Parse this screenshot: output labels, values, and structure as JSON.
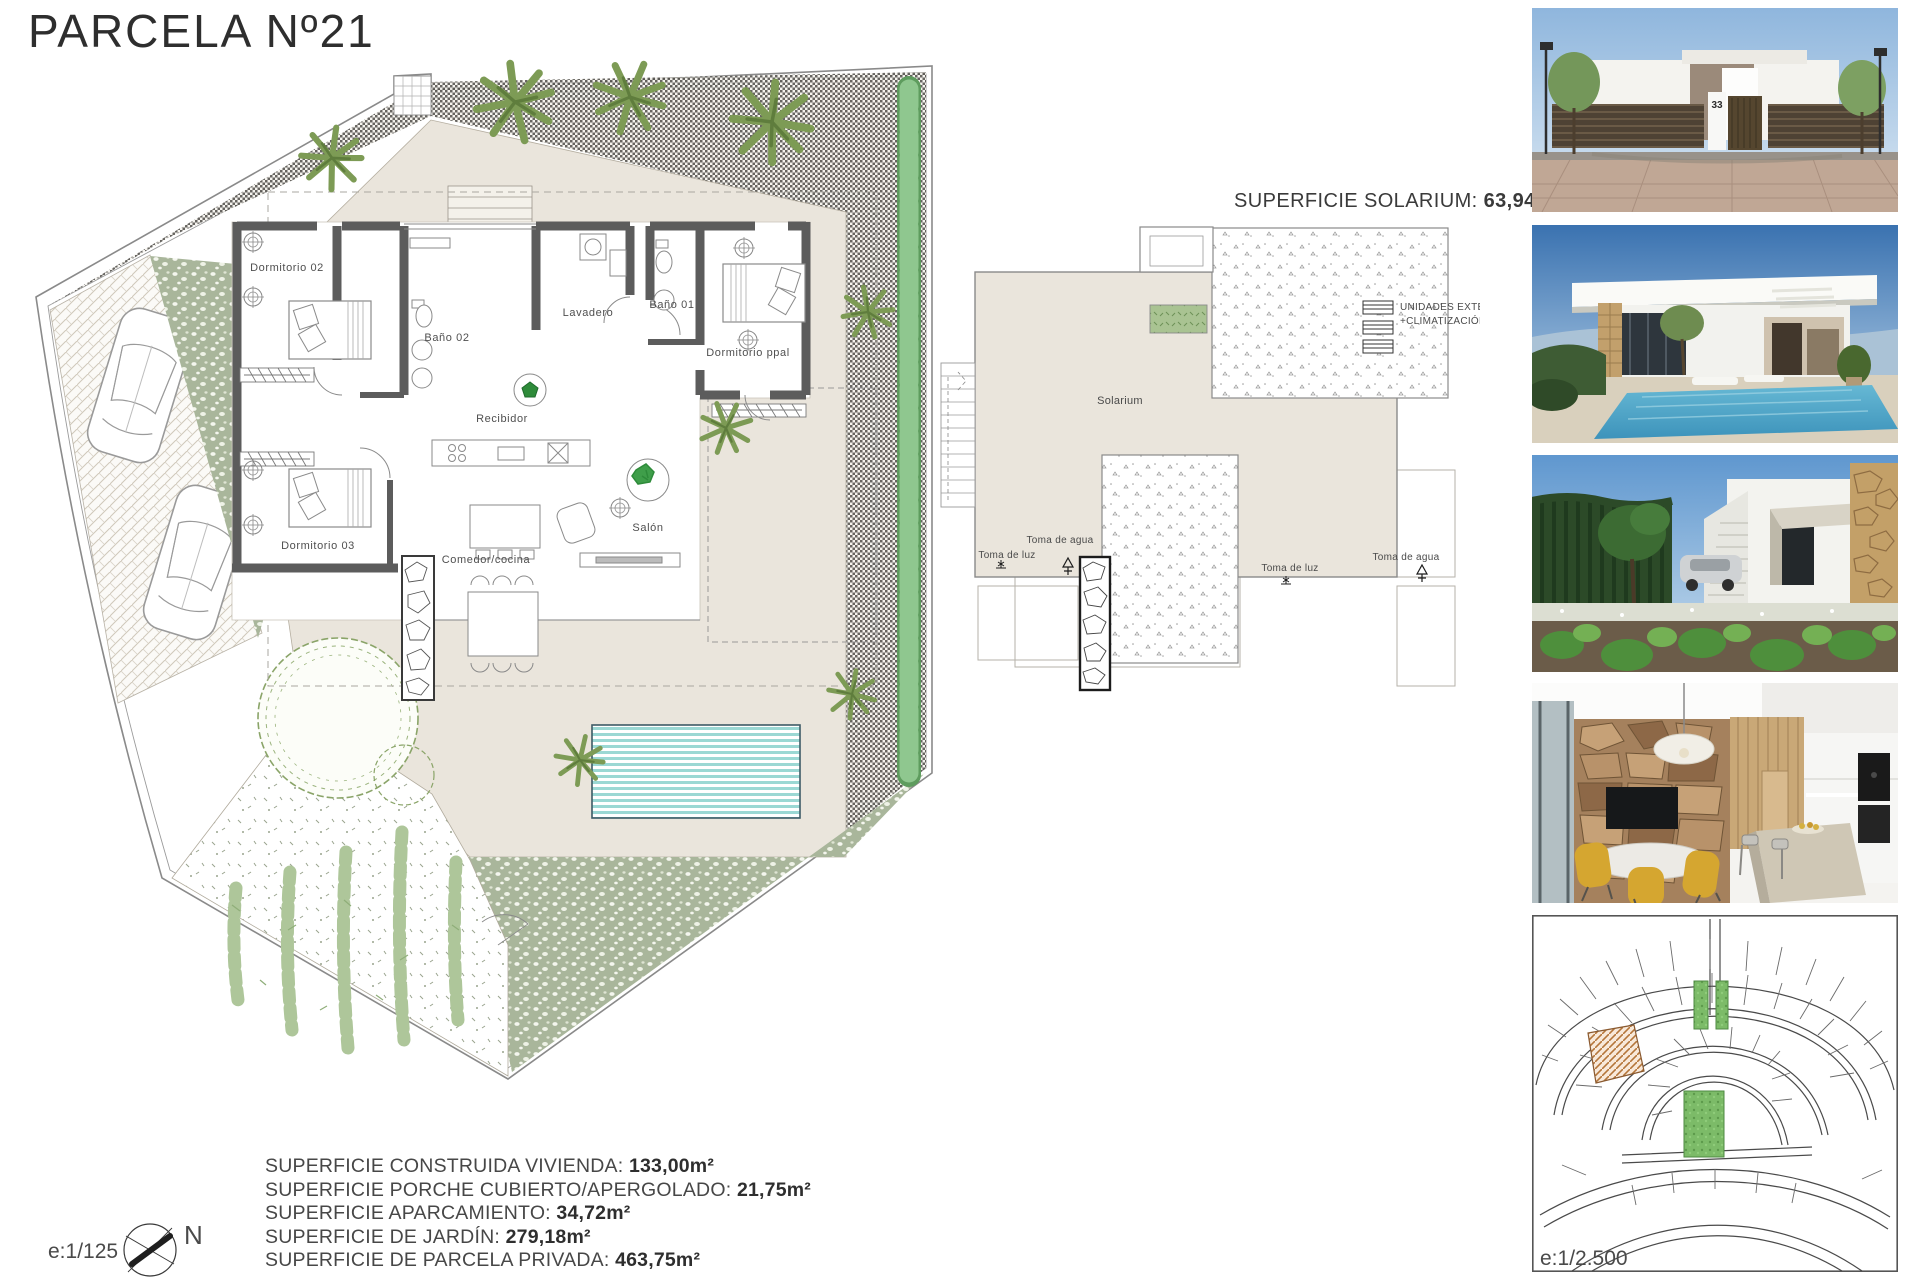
{
  "title": "PARCELA Nº21",
  "plan": {
    "rooms": [
      "Dormitorio 02",
      "Baño 02",
      "Lavadero",
      "Baño 01",
      "Dormitorio ppal",
      "Recibidor",
      "Dormitorio 03",
      "Comedor/cocina",
      "Salón"
    ],
    "scale": "e:1/125",
    "north": "N"
  },
  "solarium": {
    "title_label": "SUPERFICIE SOLARIUM:",
    "title_value": "63,94m²",
    "room": "Solarium",
    "water": "Toma de agua",
    "light": "Toma de luz",
    "ac_units_line1": "UNIDADES EXTERIORES",
    "ac_units_line2": "+CLIMATIZACIÓN"
  },
  "areas": [
    {
      "label": "SUPERFICIE CONSTRUIDA VIVIENDA: ",
      "value": "133,00m²"
    },
    {
      "label": "SUPERFICIE PORCHE CUBIERTO/APERGOLADO: ",
      "value": "21,75m²"
    },
    {
      "label": "SUPERFICIE APARCAMIENTO: ",
      "value": "34,72m²"
    },
    {
      "label": "SUPERFICIE DE JARDÍN: ",
      "value": "279,18m²"
    },
    {
      "label": "SUPERFICIE DE PARCELA PRIVADA: ",
      "value": "463,75m²"
    }
  ],
  "photos": [
    {
      "name": "street-elevation-render",
      "house_number": "33"
    },
    {
      "name": "villa-pool-render"
    },
    {
      "name": "garden-render"
    },
    {
      "name": "kitchen-interior-render"
    },
    {
      "name": "urbanization-site-plan",
      "scale": "e:1/2.500"
    }
  ],
  "colors": {
    "terrace_beige": "#EAE5DC",
    "sage_green": "#A9B69B",
    "hedge_green": "#8FC78F",
    "pool_blue": "#9BD8D4",
    "wall_gray": "#5C5C5C",
    "site_plot_highlight": "#B5763A",
    "site_green_area": "#7CBB68"
  }
}
